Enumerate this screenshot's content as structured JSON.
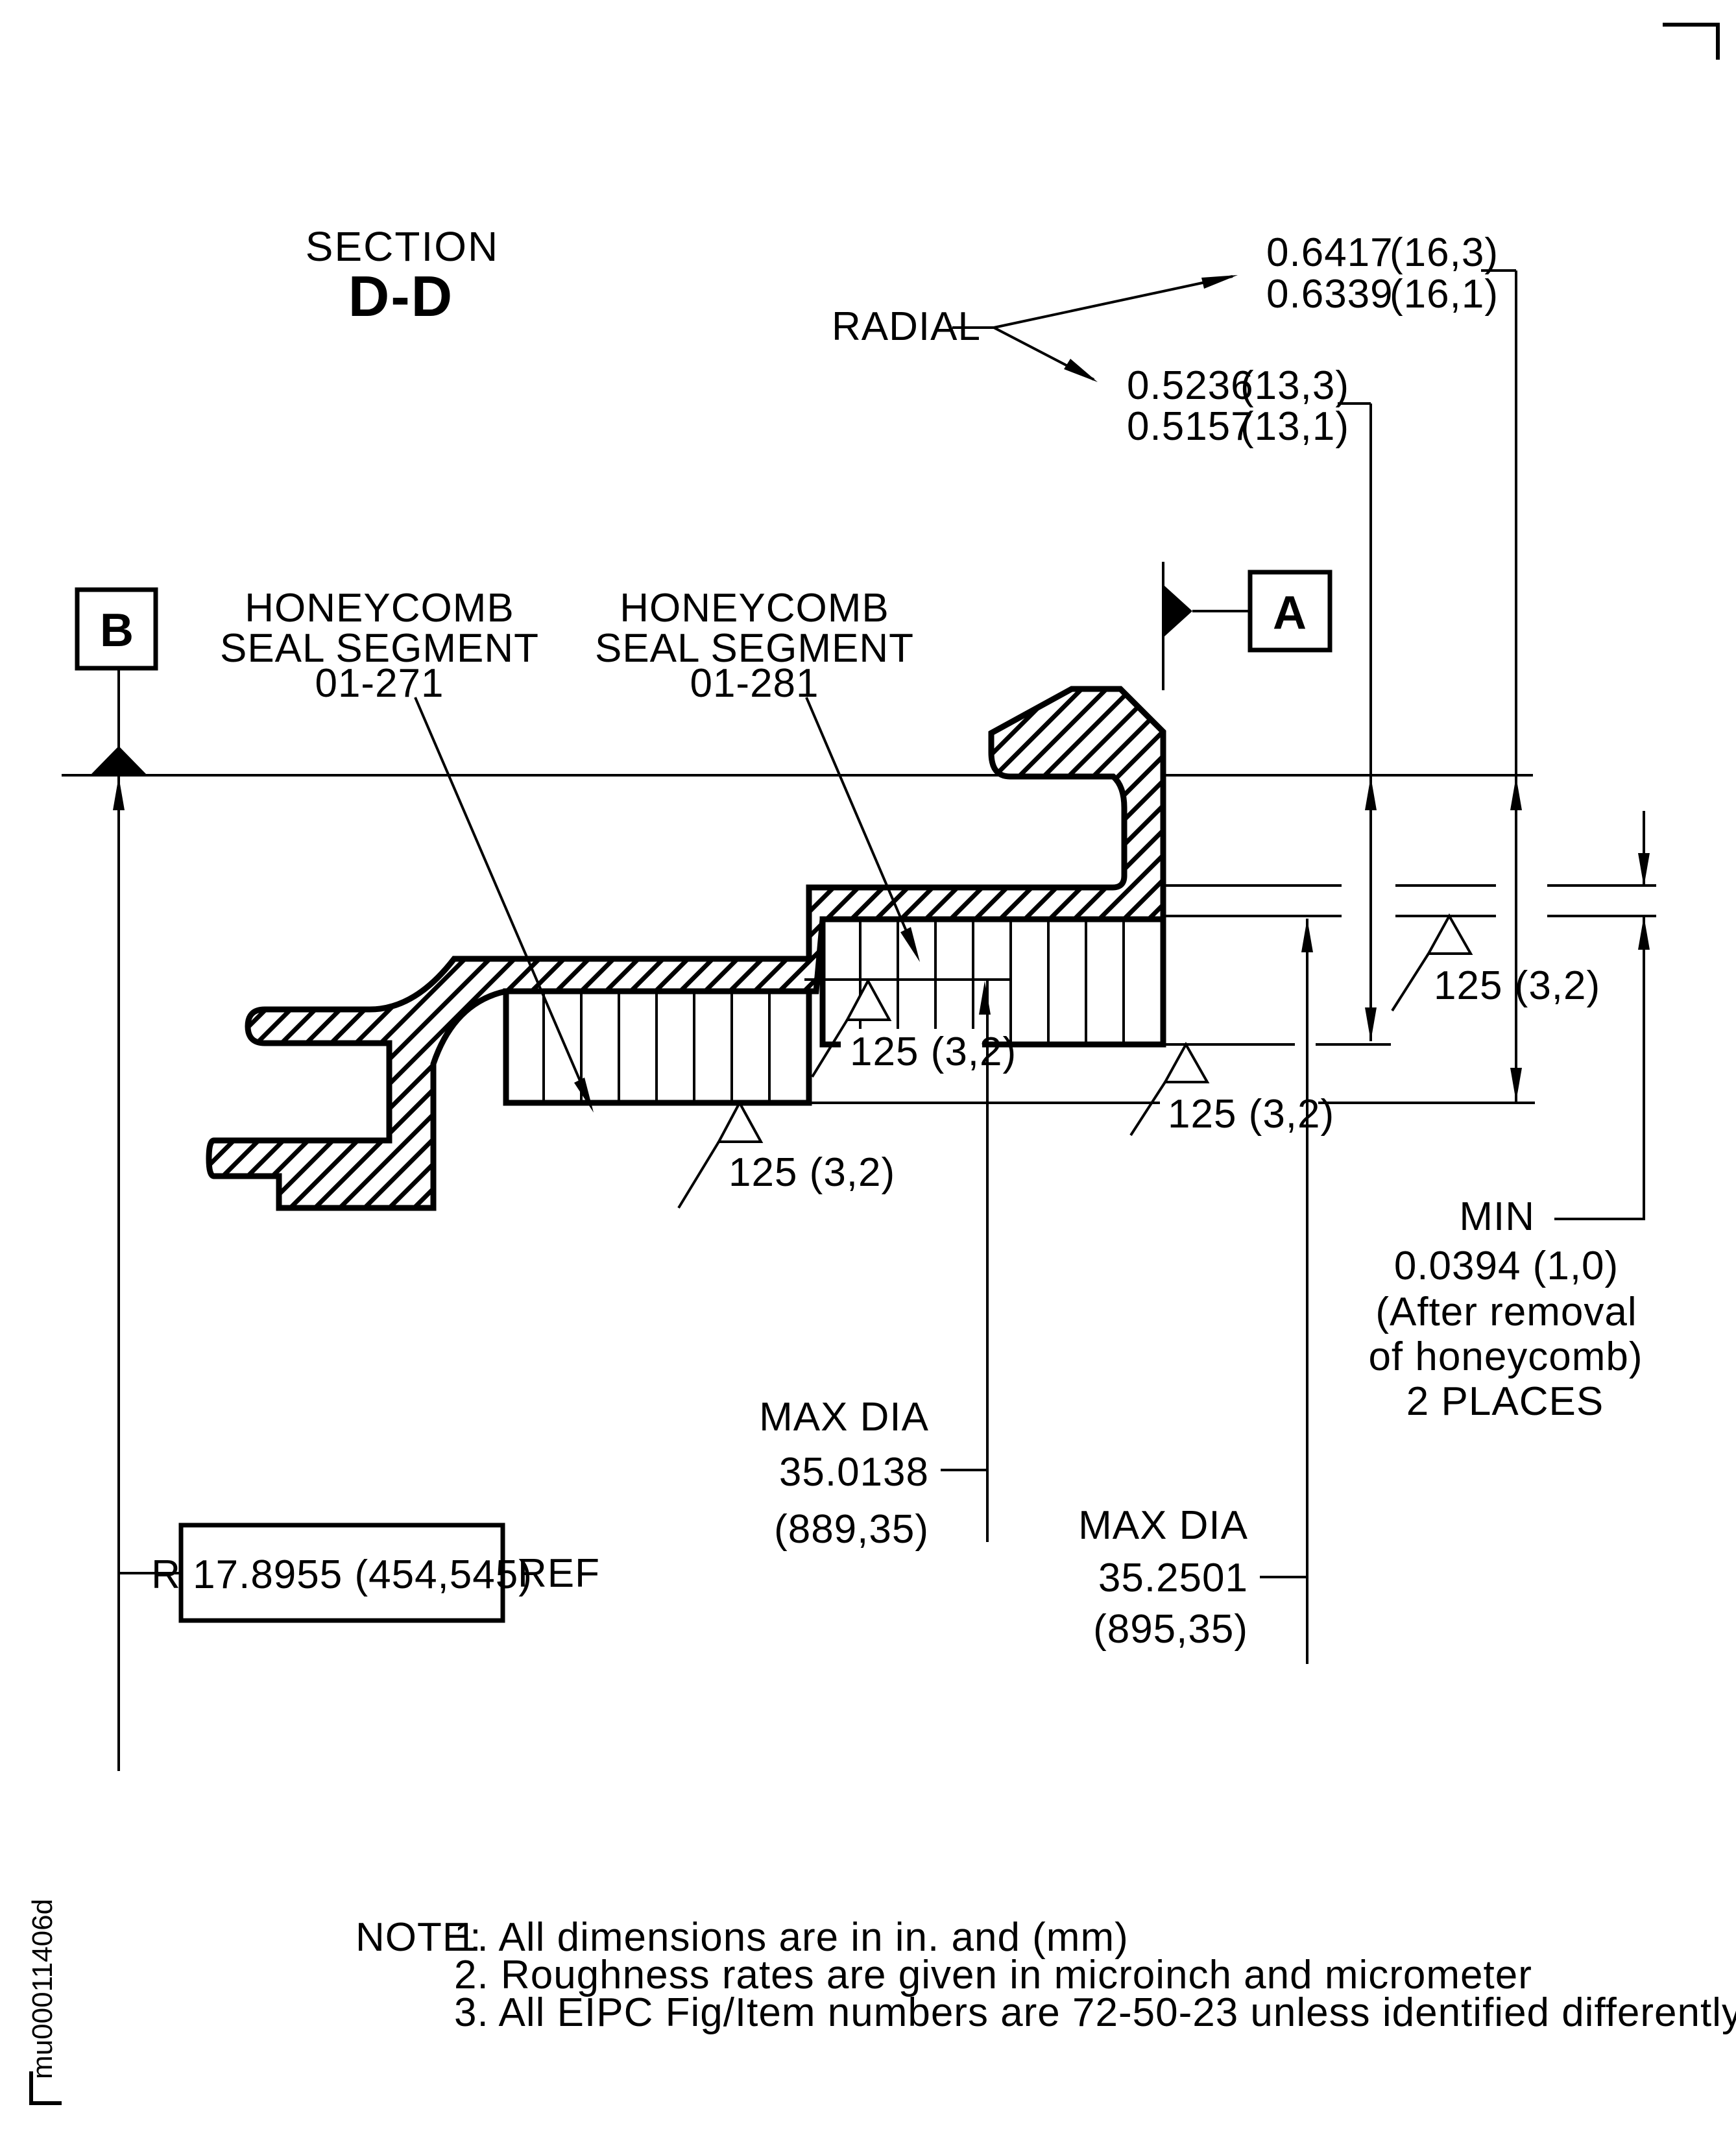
{
  "drawing": {
    "id_code": "mu00011406d",
    "title": {
      "line1": "SECTION",
      "line2": "D-D"
    },
    "radial": {
      "label": "RADIAL",
      "upper": {
        "max_in": "0.6417",
        "max_mm": "(16,3)",
        "min_in": "0.6339",
        "min_mm": "(16,1)"
      },
      "lower": {
        "max_in": "0.5236",
        "max_mm": "(13,3)",
        "min_in": "0.5157",
        "min_mm": "(13,1)"
      }
    },
    "datum_a": "A",
    "datum_b": "B",
    "segment_left": {
      "line1": "HONEYCOMB",
      "line2": "SEAL SEGMENT",
      "line3": "01-271"
    },
    "segment_right": {
      "line1": "HONEYCOMB",
      "line2": "SEAL SEGMENT",
      "line3": "01-281"
    },
    "roughness": "125 (3,2)",
    "max_dia_inner": {
      "line1": "MAX DIA",
      "line2": "35.0138",
      "line3": "(889,35)"
    },
    "max_dia_outer": {
      "line1": "MAX DIA",
      "line2": "35.2501",
      "line3": "(895,35)"
    },
    "min_callout": {
      "label": "MIN",
      "line1": "0.0394 (1,0)",
      "line2": "(After removal",
      "line3": "of honeycomb)",
      "line4": "2 PLACES"
    },
    "radius_ref": {
      "boxed": "R 17.8955 (454,545)",
      "suffix": "REF"
    },
    "notes": {
      "prefix": "NOTE:",
      "items": [
        "1. All dimensions are in in. and (mm)",
        "2. Roughness rates are given in microinch and micrometer",
        "3. All EIPC Fig/Item numbers are 72-50-23 unless identified differently"
      ]
    }
  }
}
